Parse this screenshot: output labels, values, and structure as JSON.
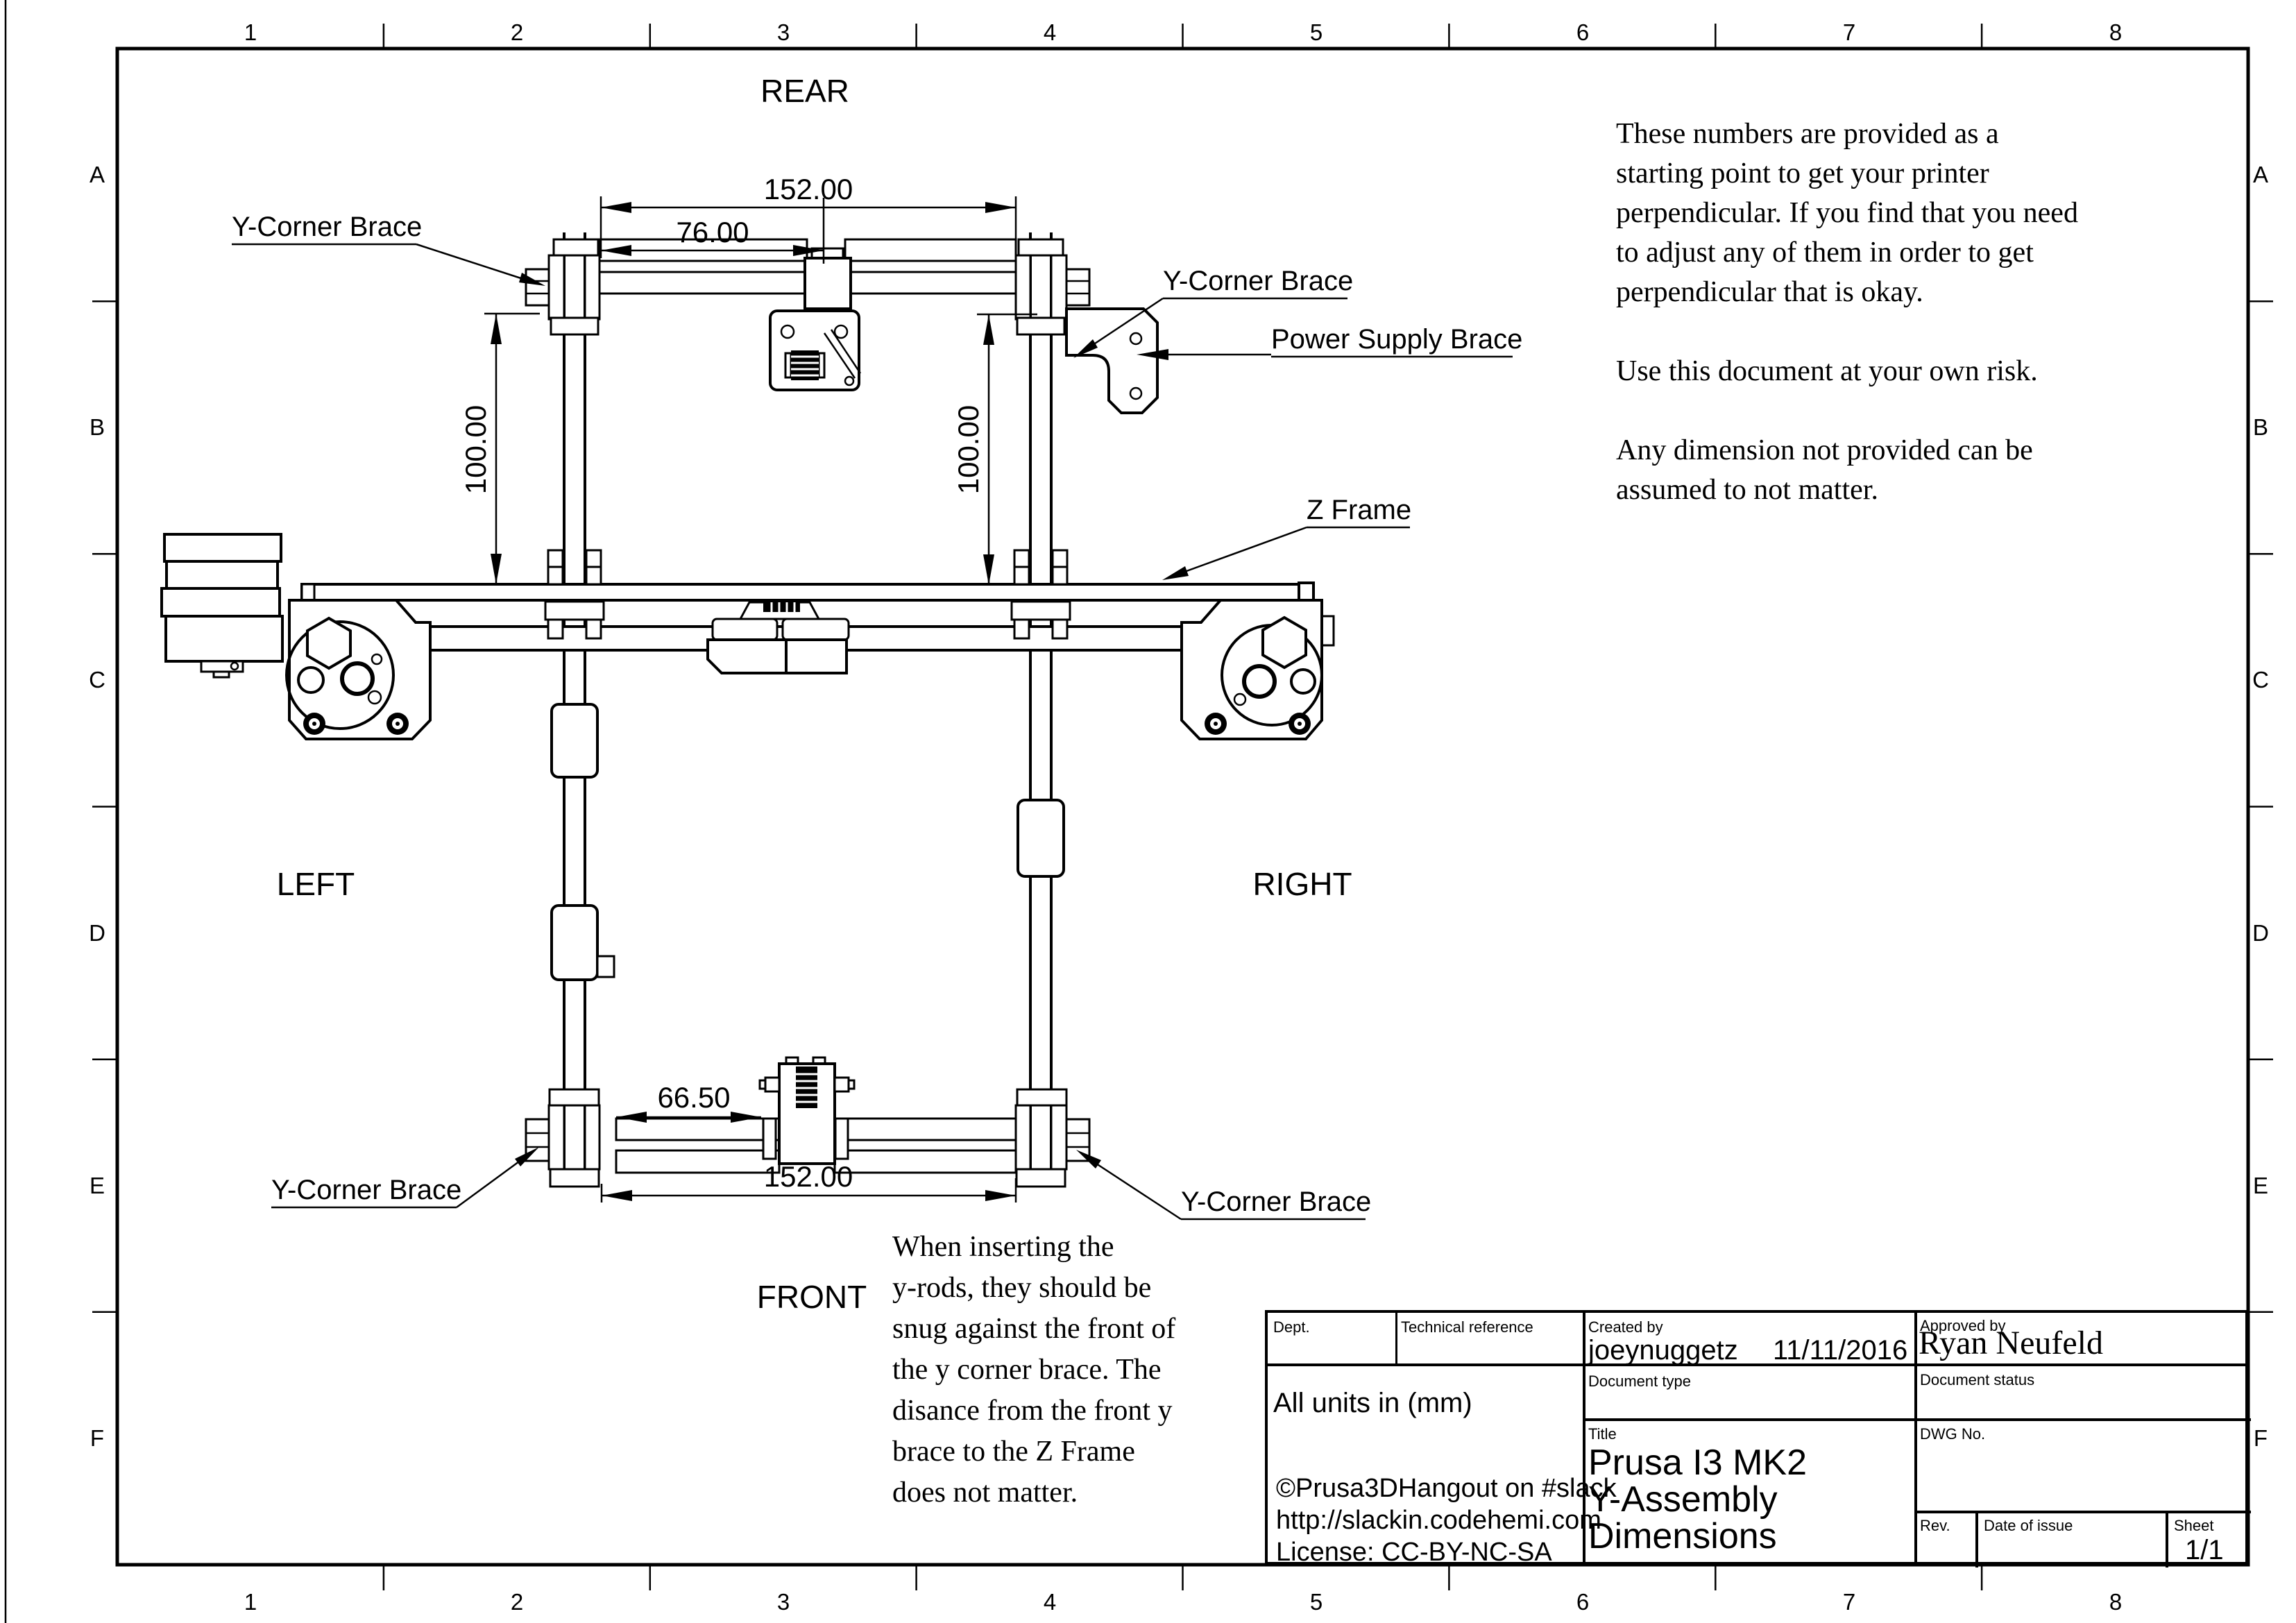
{
  "drawing": {
    "grid": {
      "columns": [
        "1",
        "2",
        "3",
        "4",
        "5",
        "6",
        "7",
        "8"
      ],
      "rows": [
        "A",
        "B",
        "C",
        "D",
        "E",
        "F"
      ]
    },
    "orientation_labels": {
      "rear": "REAR",
      "front": "FRONT",
      "left": "LEFT",
      "right": "RIGHT"
    },
    "callouts": {
      "y_corner_brace_top_left": "Y-Corner Brace",
      "y_corner_brace_top_right": "Y-Corner Brace",
      "y_corner_brace_bottom_left": "Y-Corner Brace",
      "y_corner_brace_bottom_right": "Y-Corner Brace",
      "power_supply_brace": "Power Supply Brace",
      "z_frame": "Z Frame"
    },
    "dimensions": {
      "rear_rod_spacing": "152.00",
      "rear_motor_offset": "76.00",
      "left_rod_height": "100.00",
      "right_rod_height": "100.00",
      "front_idler_offset": "66.50",
      "front_rod_spacing": "152.00"
    }
  },
  "notes": {
    "disclaimer": [
      "These numbers are provided as a",
      "starting point to get your printer",
      "perpendicular. If you find that you need",
      "to adjust any of them in order to get",
      "perpendicular that is okay.",
      "",
      "Use this document at your own risk.",
      "",
      "Any dimension not provided can be",
      "assumed to not matter."
    ],
    "front_note": [
      "When inserting the",
      "y-rods, they should be",
      "snug against the front of",
      "the y corner brace. The",
      "disance from the front y",
      "brace to the Z Frame",
      "does not matter."
    ]
  },
  "title_block": {
    "labels": {
      "dept": "Dept.",
      "technical_reference": "Technical reference",
      "created_by": "Created by",
      "approved_by": "Approved by",
      "document_type": "Document type",
      "document_status": "Document status",
      "title": "Title",
      "dwg_no": "DWG No.",
      "rev": "Rev.",
      "date_of_issue": "Date of issue",
      "sheet": "Sheet"
    },
    "created_by_value": "joeynuggetz",
    "created_date": "11/11/2016",
    "approved_by_value": "Ryan Neufeld",
    "units_note": "All units in (mm)",
    "credit_lines": [
      "©Prusa3DHangout on #slack",
      "http://slackin.codehemi.com",
      "License:  CC-BY-NC-SA"
    ],
    "title_lines": [
      "Prusa I3 MK2",
      "Y-Assembly",
      "Dimensions"
    ],
    "sheet_value": "1/1"
  }
}
